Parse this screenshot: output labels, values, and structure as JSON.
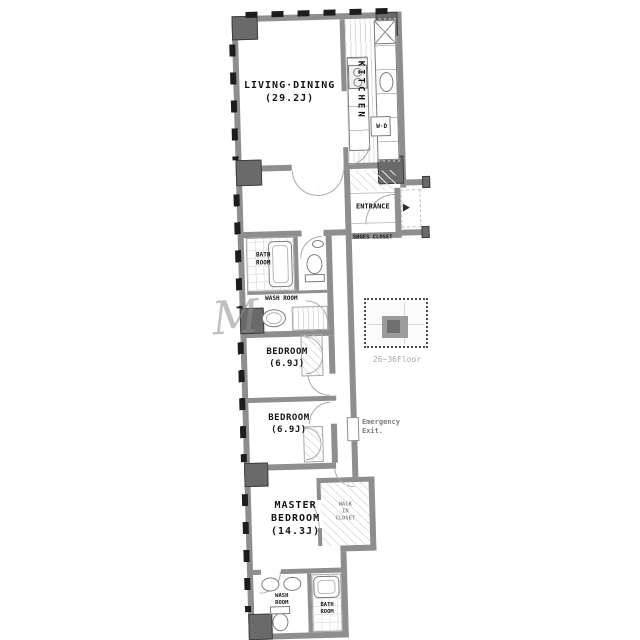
{
  "rooms": {
    "living_dining": {
      "name": "LIVING·DINING",
      "size": "(29.2J)"
    },
    "kitchen": {
      "name": "KITCHEN"
    },
    "entrance": {
      "name": "ENTRANCE"
    },
    "shoes_closet": {
      "name": "SHOES CLOSET"
    },
    "bath_room": {
      "line1": "BATH",
      "line2": "ROOM"
    },
    "wash_room": {
      "name": "WASH ROOM"
    },
    "bedroom_1": {
      "name": "BEDROOM",
      "size": "(6.9J)"
    },
    "bedroom_2": {
      "name": "BEDROOM",
      "size": "(6.9J)"
    },
    "master_bedroom": {
      "line1": "MASTER",
      "line2": "BEDROOM",
      "size": "(14.3J)"
    },
    "walk_in_closet": {
      "line1": "WALK",
      "line2": "IN",
      "line3": "CLOSET"
    },
    "wash_room_2": {
      "line1": "WASH",
      "line2": "ROOM"
    },
    "bath_room_2": {
      "line1": "BATH",
      "line2": "ROOM"
    }
  },
  "labels": {
    "emergency_exit": {
      "line1": "Emergency",
      "line2": "Exit."
    },
    "washer_dryer": "W·D",
    "key_plan_floor": "26~36Floor",
    "watermark": "M"
  },
  "colors": {
    "wall": "#8e8e8e",
    "column": "#6a6a6a",
    "text": "#141414",
    "muted_text": "#8f8f8f",
    "hatch": "#dcdcdc"
  }
}
